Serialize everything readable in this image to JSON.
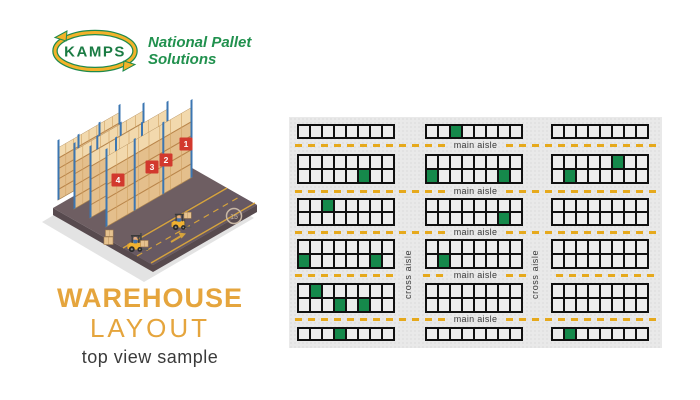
{
  "theme": {
    "accent_orange": "#e5a53d",
    "brand_green": "#21914e",
    "kamps_green": "#1a7b43",
    "occupied_green": "#15894b",
    "dash_gold": "#e6a91c",
    "cell_fill": "#ededed",
    "panel_bg": "#e9e9e9"
  },
  "logo": {
    "brand": "KAMPS",
    "tagline_line1": "National Pallet",
    "tagline_line2": "Solutions"
  },
  "title": {
    "heading_line1": "WAREHOUSE",
    "heading_line2": "LAYOUT",
    "subheading": "top view sample"
  },
  "illustration": {
    "rack_sign_numbers": [
      "1",
      "2",
      "3",
      "4"
    ],
    "speed_sign_text": "15"
  },
  "layout": {
    "cols_per_rack": 8,
    "rows_per_rack": [
      1,
      2,
      2,
      2,
      2,
      1
    ],
    "rack_rows": [
      {
        "racks": [
          {
            "occupied": []
          },
          {
            "occupied": [
              [
                1,
                3
              ]
            ]
          },
          {
            "occupied": []
          }
        ]
      },
      {
        "racks": [
          {
            "occupied": [
              [
                2,
                6
              ]
            ]
          },
          {
            "occupied": [
              [
                2,
                1
              ],
              [
                2,
                7
              ]
            ]
          },
          {
            "occupied": [
              [
                1,
                6
              ],
              [
                2,
                2
              ]
            ]
          }
        ]
      },
      {
        "racks": [
          {
            "occupied": [
              [
                1,
                3
              ]
            ]
          },
          {
            "occupied": [
              [
                2,
                7
              ]
            ]
          },
          {
            "occupied": []
          }
        ]
      },
      {
        "racks": [
          {
            "occupied": [
              [
                2,
                1
              ],
              [
                2,
                7
              ]
            ]
          },
          {
            "occupied": [
              [
                2,
                2
              ]
            ]
          },
          {
            "occupied": []
          }
        ]
      },
      {
        "racks": [
          {
            "occupied": [
              [
                1,
                2
              ],
              [
                2,
                4
              ],
              [
                2,
                6
              ]
            ]
          },
          {
            "occupied": []
          },
          {
            "occupied": []
          }
        ]
      },
      {
        "racks": [
          {
            "occupied": [
              [
                1,
                4
              ]
            ]
          },
          {
            "occupied": []
          },
          {
            "occupied": [
              [
                1,
                2
              ]
            ]
          }
        ]
      }
    ],
    "aisles": [
      {
        "label": "main aisle",
        "cross_break": false
      },
      {
        "label": "main aisle",
        "cross_break": false
      },
      {
        "label": "main aisle",
        "cross_break": false
      },
      {
        "label": "main aisle",
        "cross_break": true
      },
      {
        "label": "main aisle",
        "cross_break": false
      }
    ],
    "cross_aisles": [
      {
        "label": "cross aisle"
      },
      {
        "label": "cross aisle"
      }
    ]
  }
}
